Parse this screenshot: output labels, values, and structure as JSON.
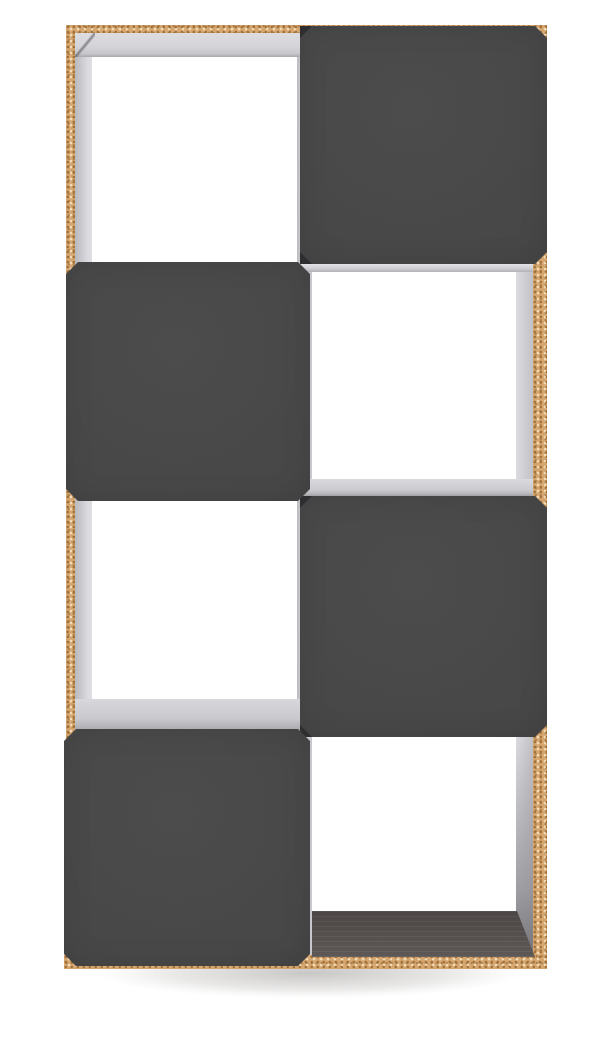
{
  "scene": {
    "type": "product-photo",
    "object": "cube storage bookcase",
    "description": "Tall two-column, four-tier cube bookcase with a natural particleboard frame, light grey interior lining, and dark charcoal chamfered panels closing alternate cubes in a checkerboard pattern, photographed on a white background with a soft floor shadow.",
    "orientation": "front view, slight perspective"
  },
  "colors": {
    "background": "#ffffff",
    "wood": "#d6a670",
    "wood_speckle_dark": "#9a6d33",
    "wood_speckle_light": "#f3ddb9",
    "panel": "#474747",
    "lining_light": "#dcdbdf",
    "lining_mid": "#c3c2c7",
    "lining_dark": "#9b9aa0",
    "floor": "#554f4d",
    "corner_shadow": "#2e2e31",
    "ground_shadow": "rgba(60,56,52,0.28)"
  },
  "grid": {
    "rows": 4,
    "cols": 2,
    "pattern": "checkerboard",
    "cells": [
      {
        "row": 1,
        "col": 1,
        "state": "open"
      },
      {
        "row": 1,
        "col": 2,
        "state": "panel"
      },
      {
        "row": 2,
        "col": 1,
        "state": "panel"
      },
      {
        "row": 2,
        "col": 2,
        "state": "open"
      },
      {
        "row": 3,
        "col": 1,
        "state": "open"
      },
      {
        "row": 3,
        "col": 2,
        "state": "panel"
      },
      {
        "row": 4,
        "col": 1,
        "state": "panel"
      },
      {
        "row": 4,
        "col": 2,
        "state": "open"
      }
    ]
  }
}
